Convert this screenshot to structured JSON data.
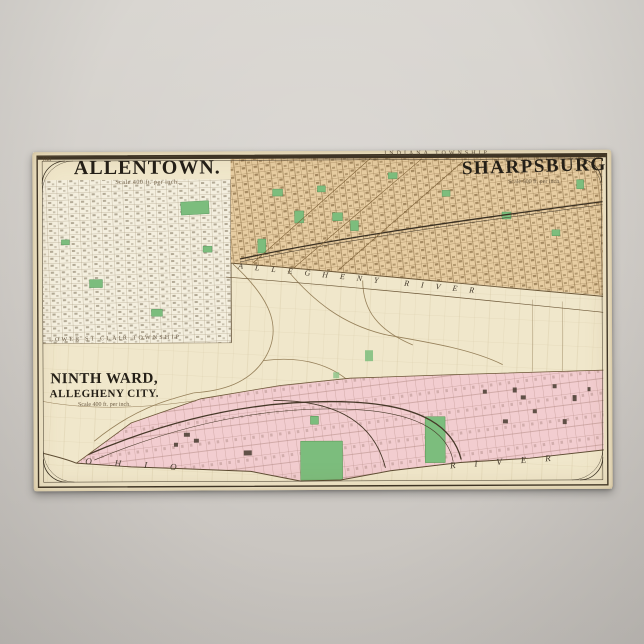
{
  "poster": {
    "page_number": "100",
    "sections": {
      "allentown": {
        "title": "ALLENTOWN.",
        "scale_note": "Scale 400 ft. per inch."
      },
      "sharpsburg": {
        "title": "SHARPSBURG",
        "scale_note": "Scale 500 ft. per inch."
      },
      "ninth_ward": {
        "title": "NINTH WARD,",
        "subtitle": "ALLEGHENY CITY.",
        "scale_note": "Scale 400 ft. per inch."
      }
    },
    "labels": {
      "indiana_township": "INDIANA TOWNSHIP",
      "lower_st_clair_township": "LOWER ST CLAIR TOWNSHIP",
      "allegheny_river": "ALLEGHENY RIVER",
      "ohio": "OHIO",
      "river": "RIVER"
    },
    "colors": {
      "paper": "#f0e7cb",
      "backdrop_gray": "#cfccc7",
      "sharpsburg_fill": "#e7cda2",
      "allentown_fill": "#f4efdf",
      "ninth_ward_fill": "#f2cdd0",
      "park_green": "#7cbd7d",
      "frame_ink": "#3a3226"
    }
  }
}
